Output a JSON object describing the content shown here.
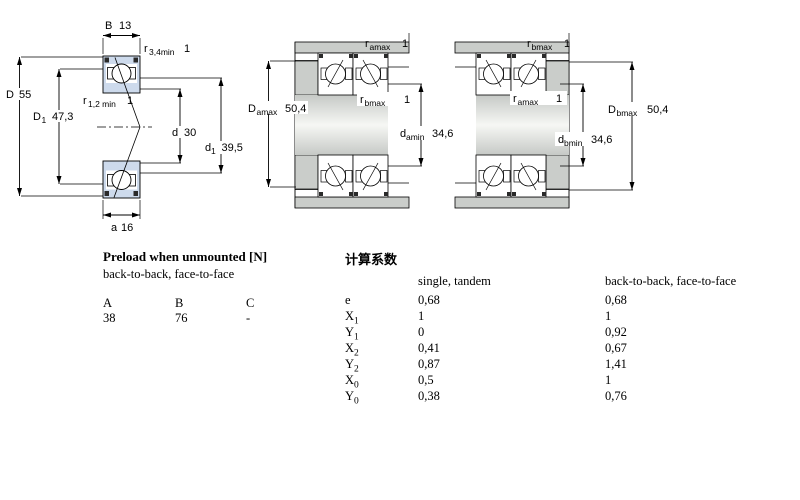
{
  "colors": {
    "bearing_fill": "#cddaec",
    "steel_gray": "#cacdca",
    "line": "#000000"
  },
  "single_bearing": {
    "B": {
      "base": "B",
      "value": "13"
    },
    "r34": {
      "base": "r",
      "sub": "3,4min",
      "value": "1"
    },
    "D": {
      "base": "D",
      "value": "55"
    },
    "D1": {
      "base": "D",
      "sub": "1",
      "value": "47,3"
    },
    "r12": {
      "base": "r",
      "sub": "1,2 min",
      "value": "1"
    },
    "d": {
      "base": "d",
      "value": "30"
    },
    "d1": {
      "base": "d",
      "sub": "1",
      "value": "39,5"
    },
    "a": {
      "base": "a",
      "value": "16"
    }
  },
  "mounted_a": {
    "r_top": {
      "base": "r",
      "sub": "amax",
      "value": "1"
    },
    "r_mid": {
      "base": "r",
      "sub": "bmax",
      "value": "1"
    },
    "D_a": {
      "base": "D",
      "sub": "amax",
      "value": "50,4"
    },
    "d_a": {
      "base": "d",
      "sub": "amin",
      "value": "34,6"
    }
  },
  "mounted_b": {
    "r_top": {
      "base": "r",
      "sub": "bmax",
      "value": "1"
    },
    "r_mid": {
      "base": "r",
      "sub": "amax",
      "value": "1"
    },
    "D_b": {
      "base": "D",
      "sub": "bmax",
      "value": "50,4"
    },
    "d_b": {
      "base": "d",
      "sub": "bmin",
      "value": "34,6"
    }
  },
  "preload_table": {
    "title": "Preload when unmounted [N]",
    "subtitle": "back-to-back, face-to-face",
    "headers": [
      "A",
      "B",
      "C"
    ],
    "values": [
      "38",
      "76",
      "-"
    ]
  },
  "factors_table": {
    "title": "计算系数",
    "col1_header": "single, tandem",
    "col2_header": "back-to-back, face-to-face",
    "rows": [
      {
        "base": "e",
        "sub": "",
        "v1": "0,68",
        "v2": "0,68"
      },
      {
        "base": "X",
        "sub": "1",
        "v1": "1",
        "v2": "1"
      },
      {
        "base": "Y",
        "sub": "1",
        "v1": "0",
        "v2": "0,92"
      },
      {
        "base": "X",
        "sub": "2",
        "v1": "0,41",
        "v2": "0,67"
      },
      {
        "base": "Y",
        "sub": "2",
        "v1": "0,87",
        "v2": "1,41"
      },
      {
        "base": "X",
        "sub": "0",
        "v1": "0,5",
        "v2": "1"
      },
      {
        "base": "Y",
        "sub": "0",
        "v1": "0,38",
        "v2": "0,76"
      }
    ]
  }
}
